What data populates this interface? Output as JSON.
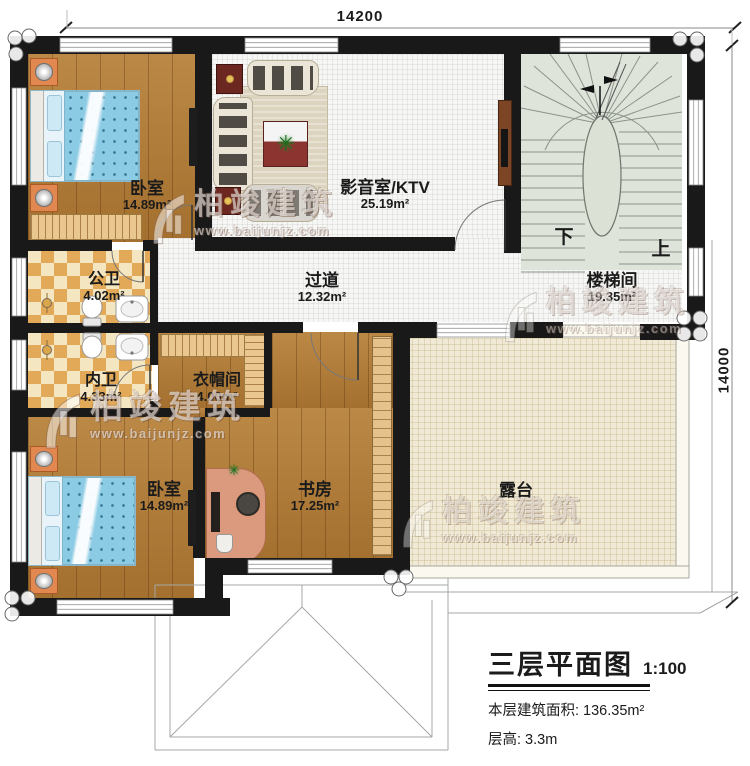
{
  "title_block": {
    "title": "三层平面图",
    "scale": "1:100",
    "floor_area": "本层建筑面积: 136.35m²",
    "floor_height": "层高: 3.3m"
  },
  "dimensions": {
    "top": "14200",
    "right": "14000"
  },
  "rooms": [
    {
      "id": "bedroom-top",
      "name": "卧室",
      "area": "14.89m²"
    },
    {
      "id": "media-room",
      "name": "影音室/KTV",
      "area": "25.19m²"
    },
    {
      "id": "stairwell",
      "name": "楼梯间",
      "area": "19.35m²"
    },
    {
      "id": "hallway",
      "name": "过道",
      "area": "12.32m²"
    },
    {
      "id": "public-bath",
      "name": "公卫",
      "area": "4.02m²"
    },
    {
      "id": "private-bath",
      "name": "内卫",
      "area": "4.33m²"
    },
    {
      "id": "cloakroom",
      "name": "衣帽间",
      "area": "4.00m²"
    },
    {
      "id": "bedroom-bottom",
      "name": "卧室",
      "area": "14.89m²"
    },
    {
      "id": "study",
      "name": "书房",
      "area": "17.25m²"
    },
    {
      "id": "terrace",
      "name": "露台",
      "area": ""
    }
  ],
  "stairs": {
    "down": "下",
    "up": "上"
  },
  "watermark": {
    "brand": "柏竣建筑",
    "url": "www.baijunjz.com"
  },
  "colors": {
    "wall": "#191919",
    "wood_floor": "#b07934",
    "tile_floor": "#f6f6f4",
    "bath_tile": "#e2a958",
    "stair_floor": "#dee4d9",
    "terrace_floor": "#f0e9d5"
  }
}
